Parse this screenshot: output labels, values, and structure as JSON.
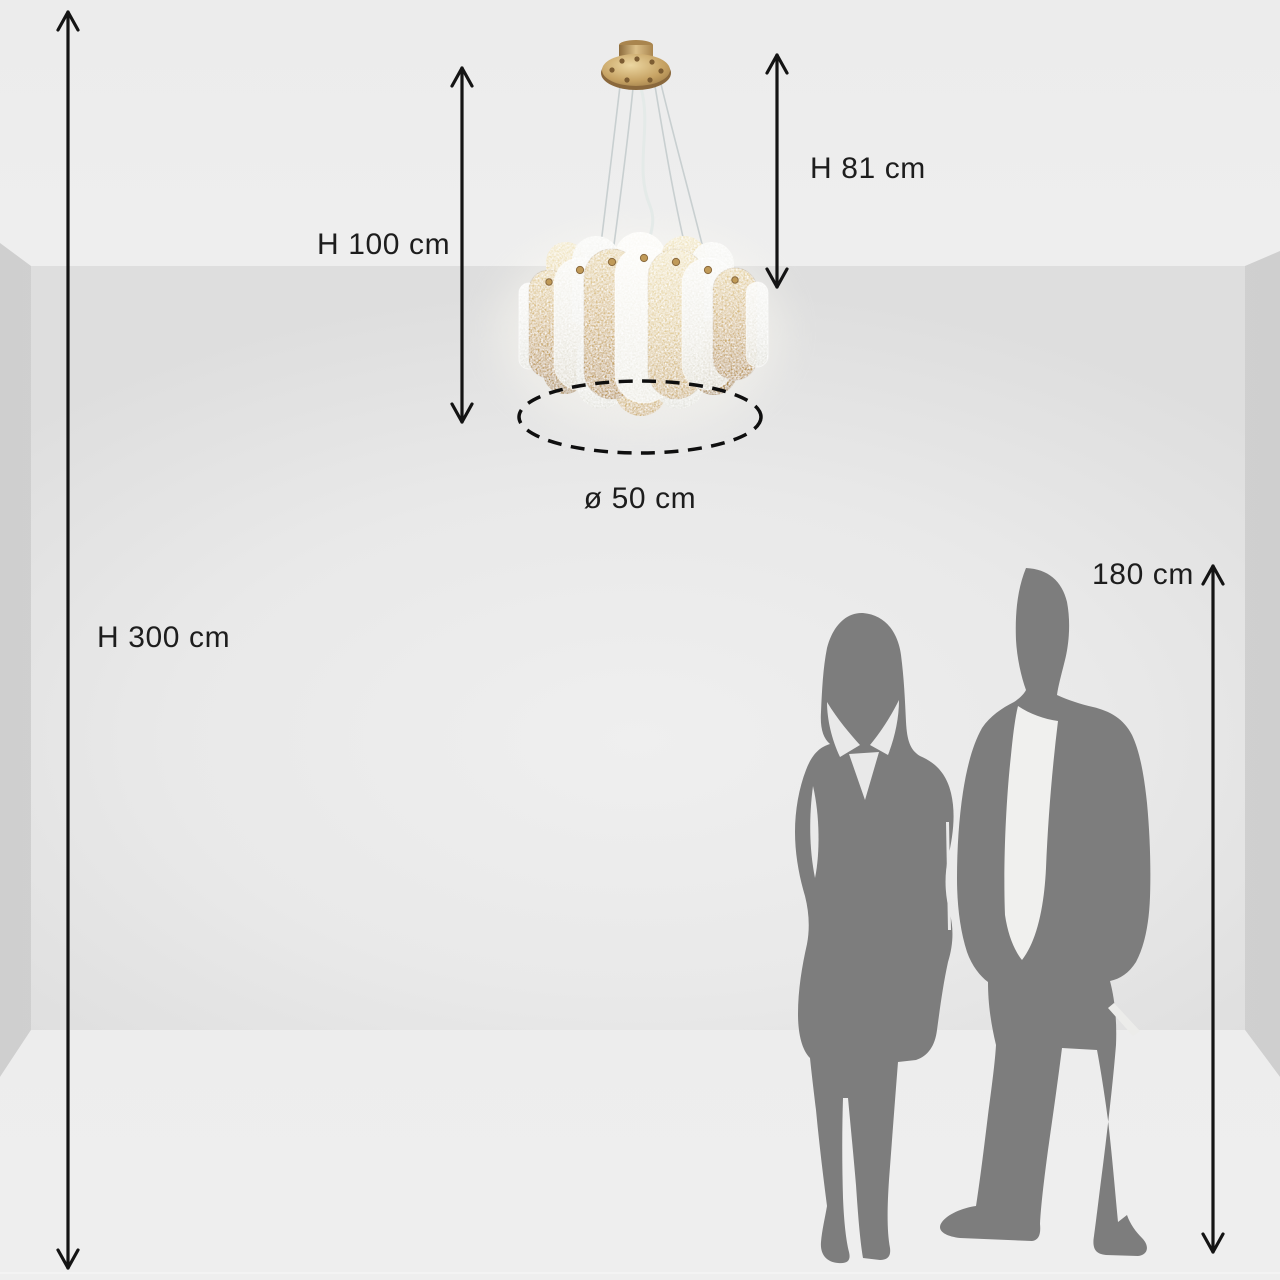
{
  "scene": {
    "description": "Pendant chandelier with frosted and amber glass oval panels shown in an empty room with dimension arrows and two human silhouettes for scale"
  },
  "labels": {
    "room_height": "H 300 cm",
    "suspension_height": "H 100 cm",
    "fixture_height": "H 81 cm",
    "diameter": "ø 50 cm",
    "person_height": "180 cm"
  },
  "colors": {
    "text": "#1d1d1d",
    "arrow": "#141414",
    "silhouette_gray": "#7d7d7d",
    "gold_accent": "#c9a663",
    "frost_glass": "#f1f0ec",
    "wall": "#e7e7e7",
    "floor": "#ececec"
  },
  "icons": {
    "arrows": [
      "double-arrow-vertical-icon"
    ],
    "diameter_marker": "dashed-ellipse-icon"
  }
}
